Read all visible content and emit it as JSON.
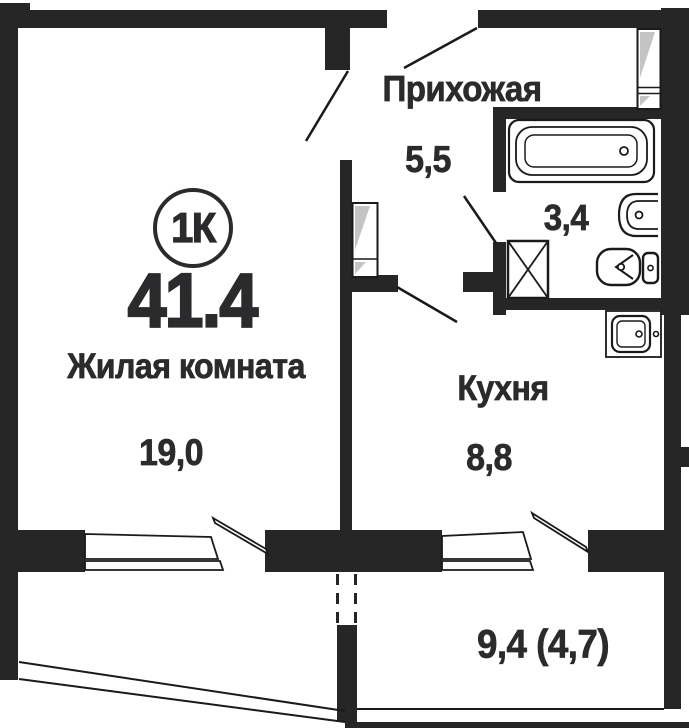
{
  "colors": {
    "wall": "#262626",
    "text": "#2b2b2d",
    "line": "#1a1a1a",
    "shade": "#c4c4c4"
  },
  "badge": {
    "label": "1К"
  },
  "total_area": "41.4",
  "rooms": {
    "living": {
      "name": "Жилая комната",
      "area": "19,0"
    },
    "hallway": {
      "name": "Прихожая",
      "area": "5,5"
    },
    "kitchen": {
      "name": "Кухня",
      "area": "8,8"
    },
    "bathroom": {
      "area": "3,4"
    },
    "balcony": {
      "area": "9,4 (4,7)"
    }
  }
}
